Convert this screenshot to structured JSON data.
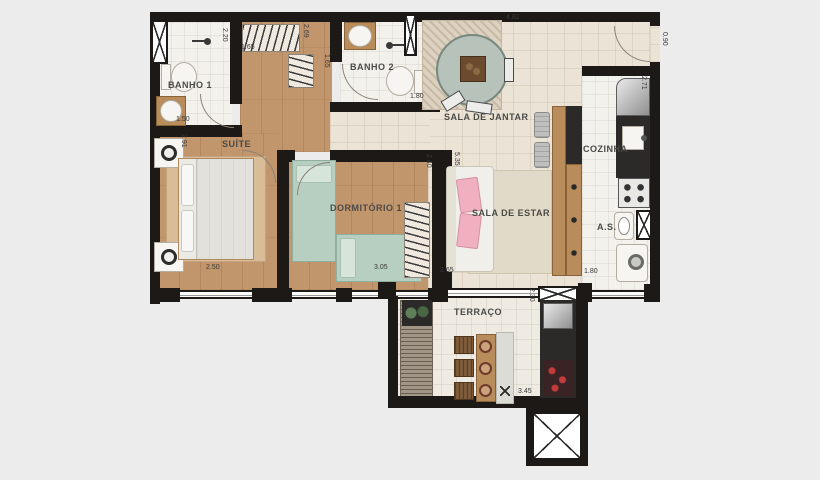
{
  "colors": {
    "background": "#ececec",
    "wall": "#1c1917",
    "wood_floor": "#c2966c",
    "tile_floor": "#f3f1ec",
    "social_floor": "#ebe3d5",
    "terrace_floor": "#efebe2",
    "accent_green": "#b7cfc0",
    "accent_pink": "#f0b0bf",
    "counter_dark": "#2c2a28"
  },
  "rooms": {
    "banho1": "BANHO 1",
    "banho2": "BANHO 2",
    "suite": "SUÍTE",
    "dormitorio1": "DORMITÓRIO 1",
    "sala_jantar": "SALA DE JANTAR",
    "sala_estar": "SALA DE ESTAR",
    "cozinha": "COZINHA",
    "area_servico": "A.S.",
    "terraco": "TERRAÇO"
  },
  "dimensions": {
    "banho1_depth": "2.20",
    "banho1_width": "1.50",
    "closet_width": "1.65",
    "hall_depth": "2.69",
    "banho2_depth": "1.65",
    "banho2_width": "1.80",
    "social_top_width": "4.82",
    "entry_door_width": "0.90",
    "cozinha_depth": "2.71",
    "suite_depth": "2.91",
    "suite_width": "2.50",
    "dorm_width": "3.05",
    "dorm_depth": "2.40",
    "sala_depth": "5.35",
    "sala_width": "2.65",
    "as_width": "1.80",
    "terraco_depth": "2.30",
    "terraco_width": "3.45"
  }
}
